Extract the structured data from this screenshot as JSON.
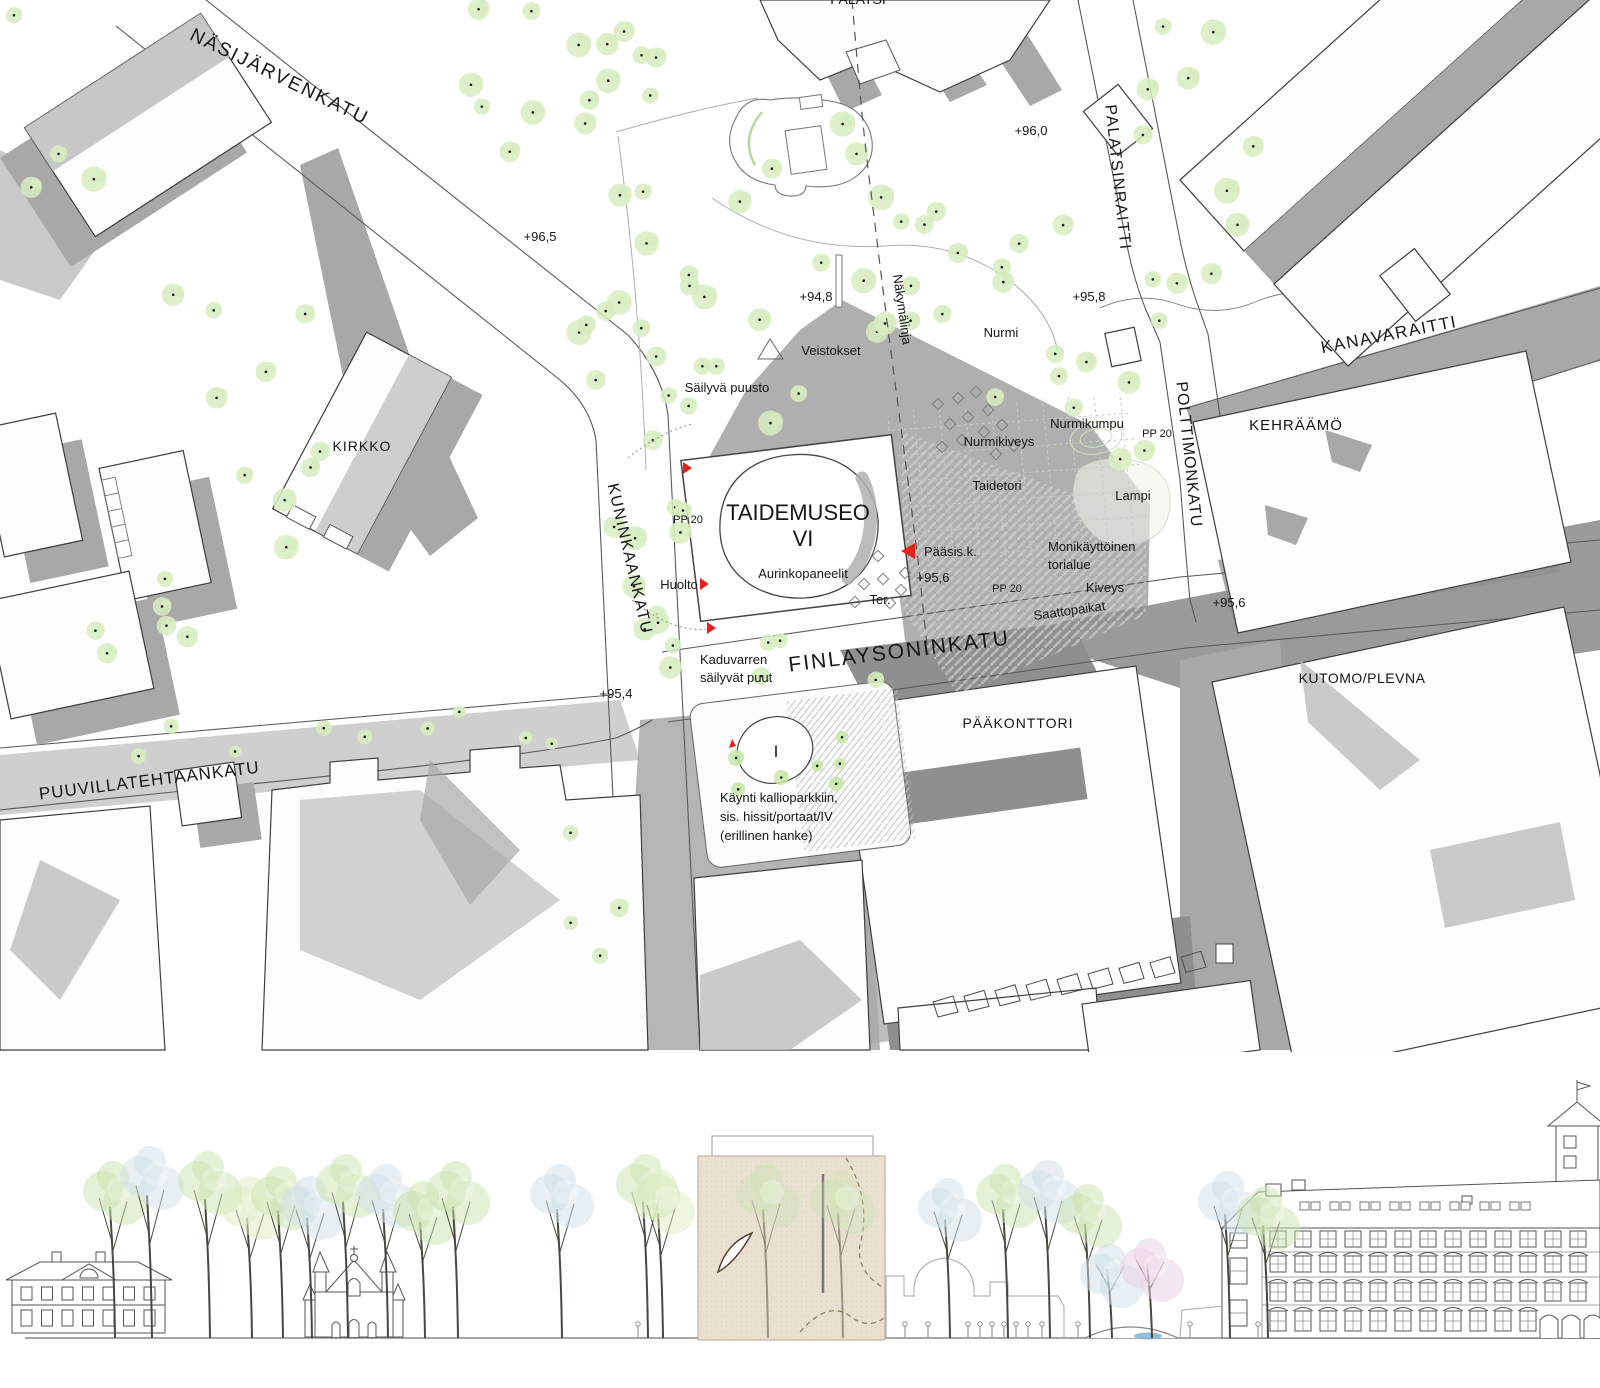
{
  "plan": {
    "streets": {
      "nasijarvenkatu": "NÄSIJÄRVENKATU",
      "kuninkaankatu": "KUNINKAANKATU",
      "finlaysoninkatu": "FINLAYSONINKATU",
      "puuvillatehtaankatu": "PUUVILLATEHTAANKATU",
      "palatsinraitti": "PALATSINRAITTI",
      "polttimonkatu": "POLTTIMONKATU",
      "kanavaraitti": "KANAVARAITTI"
    },
    "buildings": {
      "kirkko": "KIRKKO",
      "palatsi": "PALATSI",
      "kehraamo": "KEHRÄÄMÖ",
      "kutomo_plevna": "KUTOMO/PLEVNA",
      "paakonttori": "PÄÄKONTTORI",
      "taidemuseo_line1": "TAIDEMUSEO",
      "taidemuseo_line2": "VI"
    },
    "spot_elevations": {
      "park_west": "+96,5",
      "palatsi_south": "+96,0",
      "park_center": "+94,8",
      "park_east": "+95,8",
      "museum_south": "+95,6",
      "kutomo_corner": "+95,6",
      "kuninkaankatu_south": "+95,4"
    },
    "annotations": {
      "nakymalinja": "Näkymälinja",
      "veistokset": "Veistokset",
      "sailyva_puusto": "Säilyvä puusto",
      "nurmi": "Nurmi",
      "nurmikiveys": "Nurmikiveys",
      "nurmikumpu": "Nurmikumpu",
      "pp20_a": "PP 20",
      "pp20_b": "PP 20",
      "pp20_c": "PP 20",
      "taidetori": "Taidetori",
      "lampi": "Lampi",
      "paasisaankaynti": "Pääsis.k.",
      "monikayttoinen_line1": "Monikäyttöinen",
      "monikayttoinen_line2": "torialue",
      "kiveys": "Kiveys",
      "saattopaikat": "Saattopaikat",
      "aurinkopaneelit": "Aurinkopaneelit",
      "huolto": "Huolto",
      "terassi": "Ter.",
      "kaduvarren_line1": "Kaduvarren",
      "kaduvarren_line2": "säilyvät puut",
      "kaynti_line1": "Käynti kallioparkkiin,",
      "kaynti_line2": "sis. hissit/portaat/IV",
      "kaynti_line3": "(erillinen hanke)",
      "parkki_taso": "I"
    }
  },
  "colors": {
    "shadow": "#a8a8a8",
    "shadow_dark": "#8f8f8f",
    "outline": "#3f3f3f",
    "tree_green": "#d7edc0",
    "tree_green_bright": "#c7e8a8",
    "canopy_blue": "#cfe0ea",
    "canopy_pink": "#e9cfe4",
    "accent_red": "#e32119",
    "museum_tan": "#eae0d1",
    "water": "#7fb3d5"
  }
}
